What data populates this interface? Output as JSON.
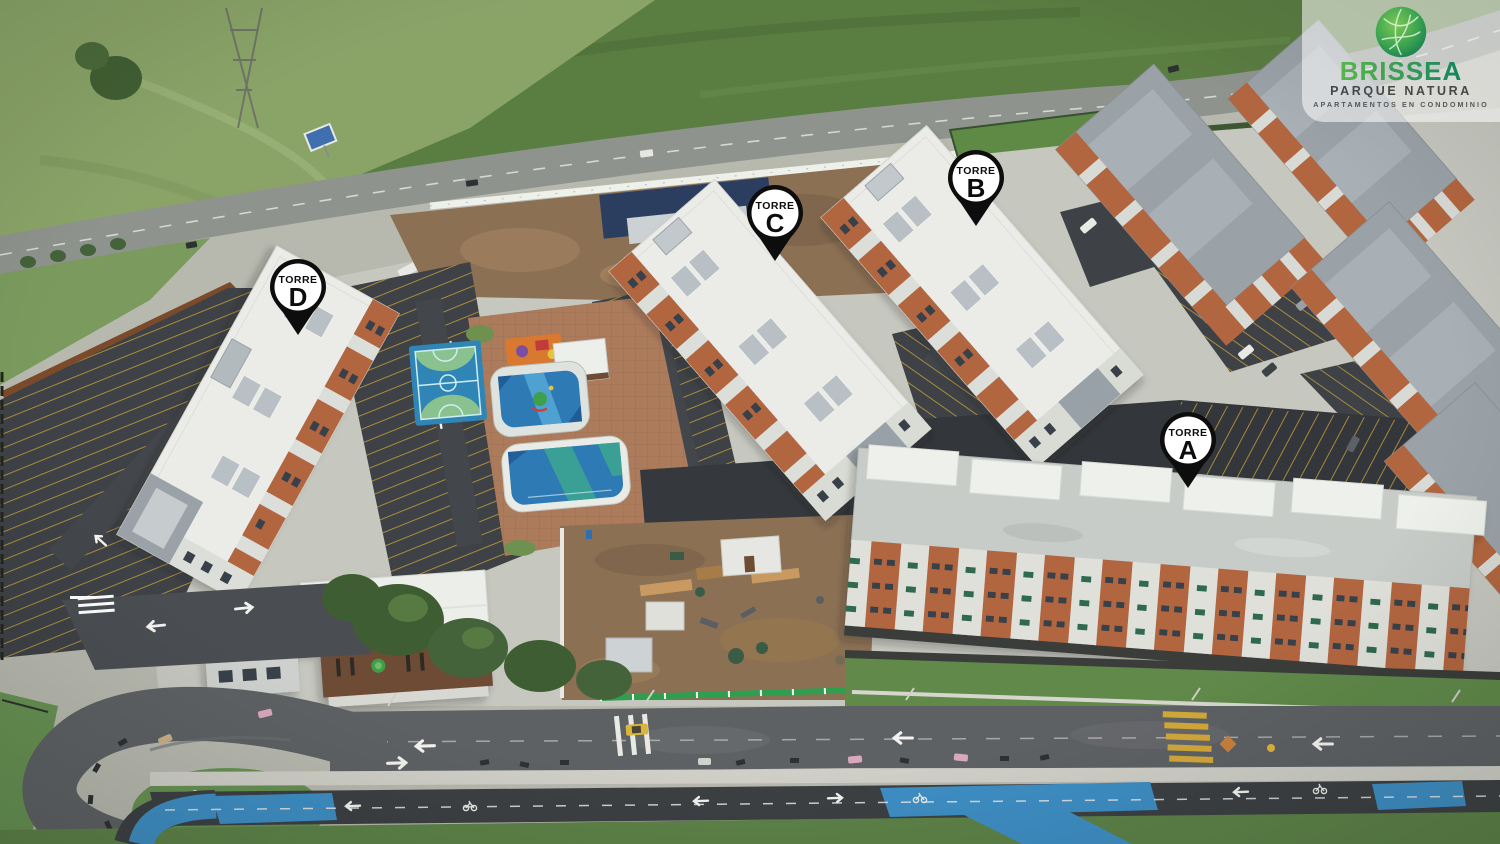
{
  "brand": {
    "name": "BRISSEA",
    "tagline": "PARQUE NATURA",
    "subtitle": "APARTAMENTOS EN CONDOMINIO"
  },
  "markers": [
    {
      "id": "torre-d",
      "label": "TORRE",
      "letter": "D",
      "x": 298,
      "y": 287
    },
    {
      "id": "torre-c",
      "label": "TORRE",
      "letter": "C",
      "x": 775,
      "y": 213
    },
    {
      "id": "torre-b",
      "label": "TORRE",
      "letter": "B",
      "x": 976,
      "y": 178
    },
    {
      "id": "torre-a",
      "label": "TORRE",
      "letter": "A",
      "x": 1188,
      "y": 440
    }
  ],
  "scene": {
    "description": "Aerial drone view of an apartment condominium under construction: four white towers labelled A to D, amenity zone with two pools, sports court and playground, dark parking lots with yellow stalls, clubhouse, construction yard, perimeter highway at top and street with blue bike path at bottom.",
    "colors": {
      "pin_black": "#0d0d0d",
      "logo_green_light": "#59b64a",
      "logo_green_dark": "#12855e",
      "bike_lane_blue": "#3e8ec4",
      "pool_blue": "#2d7ab5",
      "construction_fence_green": "#2f9e4f",
      "brick_facade": "#b2663f",
      "field_green": "#5d8044"
    }
  }
}
